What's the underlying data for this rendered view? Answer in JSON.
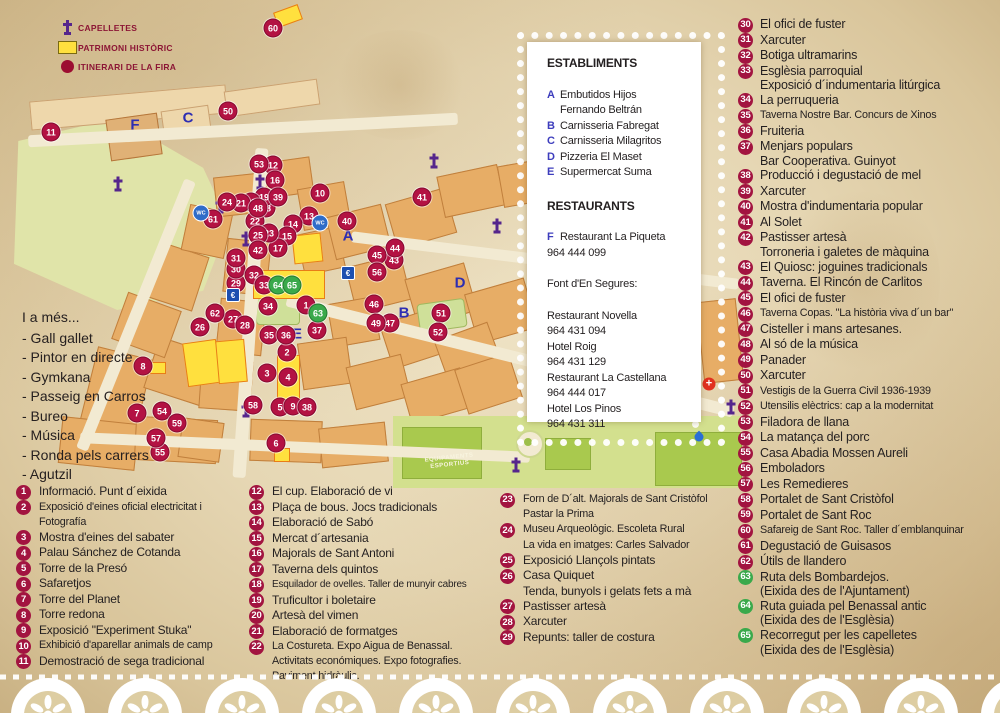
{
  "legend": {
    "items": [
      {
        "icon": "capelleta-cross-icon",
        "label": "CAPELLETES"
      },
      {
        "icon": "patrimoni-square-icon",
        "label": "PATRIMONI HISTÒRIC"
      },
      {
        "icon": "itinerari-circle-icon",
        "label": "ITINERARI DE LA FIRA"
      }
    ]
  },
  "also": {
    "title": "I a més...",
    "items": [
      "- Gall gallet",
      "- Pintor en directe",
      "- Gymkana",
      "- Passeig en Carros",
      "- Bureo",
      "- Música",
      "- Ronda pels carrers",
      "- Agutzil"
    ]
  },
  "panel": {
    "establiments_title": "ESTABLIMENTS",
    "establiments": [
      {
        "k": "A",
        "t": [
          "Embutidos Hijos",
          "Fernando Beltrán"
        ]
      },
      {
        "k": "B",
        "t": [
          "Carnisseria Fabregat"
        ]
      },
      {
        "k": "C",
        "t": [
          "Carnisseria Milagritos"
        ]
      },
      {
        "k": "D",
        "t": [
          "Pizzeria El Maset"
        ]
      },
      {
        "k": "E",
        "t": [
          "Supermercat Suma"
        ]
      }
    ],
    "restaurants_title": "RESTAURANTS",
    "restaurant_f": {
      "k": "F",
      "name": "Restaurant La Piqueta",
      "phone": "964 444 099"
    },
    "font_title": "Font d'En Segures:",
    "font_list": [
      {
        "name": "Restaurant Novella",
        "phone": "964 431 094"
      },
      {
        "name": "Hotel Roig",
        "phone": "964 431 129"
      },
      {
        "name": "Restaurant La Castellana",
        "phone": "964 444 017"
      },
      {
        "name": "Hotel Los Pinos",
        "phone": "964 431 311"
      }
    ]
  },
  "lists": {
    "col1": [
      {
        "n": "1",
        "t": [
          "Informació. Punt d´eixida"
        ]
      },
      {
        "n": "2",
        "t": [
          "Exposició d'eines oficial electricitat i",
          "Fotografía"
        ],
        "s": 1
      },
      {
        "n": "3",
        "t": [
          "Mostra d'eines del sabater"
        ]
      },
      {
        "n": "4",
        "t": [
          "Palau Sánchez de Cotanda"
        ]
      },
      {
        "n": "5",
        "t": [
          "Torre de la Presó"
        ]
      },
      {
        "n": "6",
        "t": [
          "Safaretjos"
        ]
      },
      {
        "n": "7",
        "t": [
          "Torre del Planet"
        ]
      },
      {
        "n": "8",
        "t": [
          "Torre redona"
        ]
      },
      {
        "n": "9",
        "t": [
          "Exposició \"Experiment Stuka\""
        ]
      },
      {
        "n": "10",
        "t": [
          "Exhibició d'aparellar animals de camp"
        ],
        "s": 1
      },
      {
        "n": "11",
        "t": [
          "Demostració de sega tradicional"
        ]
      }
    ],
    "col2": [
      {
        "n": "12",
        "t": [
          "El cup. Elaboració de vi"
        ]
      },
      {
        "n": "13",
        "t": [
          "Plaça de bous. Jocs tradicionals"
        ]
      },
      {
        "n": "14",
        "t": [
          "Elaboració de Sabó"
        ]
      },
      {
        "n": "15",
        "t": [
          "Mercat d´artesania"
        ]
      },
      {
        "n": "16",
        "t": [
          "Majorals de Sant Antoni"
        ]
      },
      {
        "n": "17",
        "t": [
          "Taverna dels quintos"
        ]
      },
      {
        "n": "18",
        "t": [
          "Esquilador de ovelles. Taller de munyir cabres"
        ],
        "s": 2
      },
      {
        "n": "19",
        "t": [
          "Truficultor i boletaire"
        ]
      },
      {
        "n": "20",
        "t": [
          "Artesà del vimen"
        ]
      },
      {
        "n": "21",
        "t": [
          "Elaboració de formatges"
        ]
      },
      {
        "n": "22",
        "t": [
          "La Costureta. Expo Aigua de Benassal.",
          "Activitats económiques. Expo fotografies.",
          "Paviment hidràulic."
        ],
        "s": 1
      }
    ],
    "col3": [
      {
        "n": "23",
        "t": [
          "Forn de D´alt. Majorals de Sant Cristòfol",
          "Pastar la Prima"
        ],
        "s": 1
      },
      {
        "n": "24",
        "t": [
          "Museu Arqueològic. Escoleta Rural",
          "La vida en imatges: Carles Salvador"
        ],
        "s": 1
      },
      {
        "n": "25",
        "t": [
          "Exposició Llançols pintats"
        ]
      },
      {
        "n": "26",
        "t": [
          "Casa Quiquet",
          "Tenda, bunyols i gelats fets a mà"
        ]
      },
      {
        "n": "27",
        "t": [
          "Pastisser artesà"
        ]
      },
      {
        "n": "28",
        "t": [
          "Xarcuter"
        ]
      },
      {
        "n": "29",
        "t": [
          "Repunts: taller de costura"
        ]
      }
    ],
    "colR": [
      {
        "n": "30",
        "t": [
          "El ofici de fuster"
        ]
      },
      {
        "n": "31",
        "t": [
          "Xarcuter"
        ]
      },
      {
        "n": "32",
        "t": [
          "Botiga ultramarins"
        ]
      },
      {
        "n": "33",
        "t": [
          "Esglèsia parroquial",
          "Exposició d´indumentaria litúrgica"
        ]
      },
      {
        "n": "34",
        "t": [
          "La perruqueria"
        ]
      },
      {
        "n": "35",
        "t": [
          "Taverna Nostre Bar. Concurs de Xinos"
        ],
        "s": 1
      },
      {
        "n": "36",
        "t": [
          "Fruiteria"
        ]
      },
      {
        "n": "37",
        "t": [
          "Menjars populars",
          "Bar Cooperativa. Guinyot"
        ]
      },
      {
        "n": "38",
        "t": [
          "Producció i degustació de mel"
        ]
      },
      {
        "n": "39",
        "t": [
          "Xarcuter"
        ]
      },
      {
        "n": "40",
        "t": [
          "Mostra d'indumentaria popular"
        ]
      },
      {
        "n": "41",
        "t": [
          "Al Solet"
        ]
      },
      {
        "n": "42",
        "t": [
          "Pastisser artesà",
          "Torroneria i galetes de màquina"
        ]
      },
      {
        "n": "43",
        "t": [
          "El Quiosc: joguines tradicionals"
        ]
      },
      {
        "n": "44",
        "t": [
          "Taverna. El Rincón de Carlitos"
        ]
      },
      {
        "n": "45",
        "t": [
          "El ofici de fuster"
        ]
      },
      {
        "n": "46",
        "t": [
          "Taverna Copas. \"La història viva d´un bar\""
        ],
        "s": 1
      },
      {
        "n": "47",
        "t": [
          "Cisteller i mans artesanes."
        ]
      },
      {
        "n": "48",
        "t": [
          "Al só de la música"
        ]
      },
      {
        "n": "49",
        "t": [
          "Panader"
        ]
      },
      {
        "n": "50",
        "t": [
          "Xarcuter"
        ]
      },
      {
        "n": "51",
        "t": [
          "Vestigis de la Guerra Civil 1936-1939"
        ],
        "s": 1
      },
      {
        "n": "52",
        "t": [
          "Utensilis elèctrics: cap a la modernitat"
        ],
        "s": 1
      },
      {
        "n": "53",
        "t": [
          "Filadora de llana"
        ]
      },
      {
        "n": "54",
        "t": [
          "La matança del porc"
        ]
      },
      {
        "n": "55",
        "t": [
          "Casa Abadia Mossen Aureli"
        ]
      },
      {
        "n": "56",
        "t": [
          "Emboladors"
        ]
      },
      {
        "n": "57",
        "t": [
          "Les Remedieres"
        ]
      },
      {
        "n": "58",
        "t": [
          "Portalet de Sant Cristòfol"
        ]
      },
      {
        "n": "59",
        "t": [
          "Portalet de Sant Roc"
        ]
      },
      {
        "n": "60",
        "t": [
          "Safareig de Sant Roc. Taller d´emblanquinar"
        ],
        "s": 1
      },
      {
        "n": "61",
        "t": [
          "Degustació de Guisasos"
        ]
      },
      {
        "n": "62",
        "t": [
          "Útils de llandero"
        ]
      },
      {
        "n": "63",
        "t": [
          "Ruta dels Bombardejos.",
          "(Eixida des de l'Ajuntament)"
        ],
        "g": true
      },
      {
        "n": "64",
        "t": [
          "Ruta guiada pel Benassal antic",
          "(Eixida des de l'Esglèsia)"
        ],
        "g": true
      },
      {
        "n": "65",
        "t": [
          "Recorregut per les capelletes",
          "(Eixida des de l'Esglèsia)"
        ],
        "g": true
      }
    ]
  },
  "map": {
    "markers": [
      {
        "n": "1",
        "x": 306,
        "y": 305
      },
      {
        "n": "2",
        "x": 287,
        "y": 352
      },
      {
        "n": "3",
        "x": 267,
        "y": 373
      },
      {
        "n": "4",
        "x": 288,
        "y": 377
      },
      {
        "n": "5",
        "x": 280,
        "y": 407
      },
      {
        "n": "6",
        "x": 276,
        "y": 443
      },
      {
        "n": "7",
        "x": 137,
        "y": 413
      },
      {
        "n": "8",
        "x": 143,
        "y": 366
      },
      {
        "n": "9",
        "x": 293,
        "y": 406
      },
      {
        "n": "10",
        "x": 320,
        "y": 193
      },
      {
        "n": "11",
        "x": 51,
        "y": 132
      },
      {
        "n": "12",
        "x": 273,
        "y": 165
      },
      {
        "n": "13",
        "x": 309,
        "y": 216
      },
      {
        "n": "14",
        "x": 293,
        "y": 224
      },
      {
        "n": "15",
        "x": 287,
        "y": 236
      },
      {
        "n": "16",
        "x": 275,
        "y": 180
      },
      {
        "n": "17",
        "x": 278,
        "y": 248
      },
      {
        "n": "18",
        "x": 266,
        "y": 208
      },
      {
        "n": "19",
        "x": 264,
        "y": 197
      },
      {
        "n": "20",
        "x": 251,
        "y": 202
      },
      {
        "n": "21",
        "x": 241,
        "y": 203
      },
      {
        "n": "22",
        "x": 255,
        "y": 221
      },
      {
        "n": "23",
        "x": 269,
        "y": 233
      },
      {
        "n": "24",
        "x": 227,
        "y": 202
      },
      {
        "n": "25",
        "x": 258,
        "y": 235
      },
      {
        "n": "26",
        "x": 200,
        "y": 327
      },
      {
        "n": "27",
        "x": 233,
        "y": 319
      },
      {
        "n": "28",
        "x": 245,
        "y": 325
      },
      {
        "n": "29",
        "x": 236,
        "y": 283
      },
      {
        "n": "30",
        "x": 236,
        "y": 269
      },
      {
        "n": "31",
        "x": 236,
        "y": 258
      },
      {
        "n": "32",
        "x": 254,
        "y": 275
      },
      {
        "n": "33",
        "x": 264,
        "y": 285
      },
      {
        "n": "34",
        "x": 268,
        "y": 306
      },
      {
        "n": "35",
        "x": 269,
        "y": 335
      },
      {
        "n": "36",
        "x": 286,
        "y": 335
      },
      {
        "n": "37",
        "x": 317,
        "y": 330
      },
      {
        "n": "38",
        "x": 307,
        "y": 407
      },
      {
        "n": "39",
        "x": 278,
        "y": 197
      },
      {
        "n": "40",
        "x": 347,
        "y": 221
      },
      {
        "n": "41",
        "x": 422,
        "y": 197
      },
      {
        "n": "42",
        "x": 258,
        "y": 250
      },
      {
        "n": "43",
        "x": 394,
        "y": 260
      },
      {
        "n": "44",
        "x": 395,
        "y": 248
      },
      {
        "n": "45",
        "x": 377,
        "y": 255
      },
      {
        "n": "46",
        "x": 374,
        "y": 304
      },
      {
        "n": "47",
        "x": 390,
        "y": 323
      },
      {
        "n": "48",
        "x": 258,
        "y": 208
      },
      {
        "n": "49",
        "x": 376,
        "y": 323
      },
      {
        "n": "50",
        "x": 228,
        "y": 111
      },
      {
        "n": "51",
        "x": 441,
        "y": 313
      },
      {
        "n": "52",
        "x": 438,
        "y": 332
      },
      {
        "n": "53",
        "x": 259,
        "y": 164
      },
      {
        "n": "54",
        "x": 162,
        "y": 411
      },
      {
        "n": "55",
        "x": 160,
        "y": 452
      },
      {
        "n": "56",
        "x": 377,
        "y": 272
      },
      {
        "n": "57",
        "x": 156,
        "y": 438
      },
      {
        "n": "58",
        "x": 253,
        "y": 405
      },
      {
        "n": "59",
        "x": 177,
        "y": 423
      },
      {
        "n": "60",
        "x": 273,
        "y": 28
      },
      {
        "n": "61",
        "x": 213,
        "y": 219
      },
      {
        "n": "62",
        "x": 215,
        "y": 313
      },
      {
        "n": "63",
        "x": 318,
        "y": 313,
        "g": true
      },
      {
        "n": "64",
        "x": 278,
        "y": 285,
        "g": true
      },
      {
        "n": "65",
        "x": 292,
        "y": 285,
        "g": true
      }
    ],
    "letters": [
      {
        "ch": "A",
        "x": 348,
        "y": 236
      },
      {
        "ch": "B",
        "x": 404,
        "y": 313
      },
      {
        "ch": "C",
        "x": 188,
        "y": 118
      },
      {
        "ch": "D",
        "x": 460,
        "y": 283
      },
      {
        "ch": "E",
        "x": 297,
        "y": 334
      },
      {
        "ch": "F",
        "x": 135,
        "y": 125
      }
    ],
    "wc": [
      {
        "x": 201,
        "y": 213
      },
      {
        "x": 320,
        "y": 223
      }
    ],
    "euro": [
      {
        "x": 233,
        "y": 295
      },
      {
        "x": 348,
        "y": 273
      }
    ],
    "crosses": [
      {
        "x": 260,
        "y": 182
      },
      {
        "x": 246,
        "y": 239
      },
      {
        "x": 434,
        "y": 161
      },
      {
        "x": 497,
        "y": 226
      },
      {
        "x": 246,
        "y": 410
      },
      {
        "x": 516,
        "y": 465
      },
      {
        "x": 731,
        "y": 407
      },
      {
        "x": 118,
        "y": 184
      },
      {
        "x": 220,
        "y": 206
      }
    ],
    "star": {
      "x": 709,
      "y": 384,
      "glyph": "+"
    },
    "drop": {
      "x": 699,
      "y": 437
    },
    "labels": [
      {
        "x": 425,
        "y": 455,
        "lines": [
          "EQUIPAMENTS",
          "ESPORTIUS"
        ]
      }
    ]
  }
}
